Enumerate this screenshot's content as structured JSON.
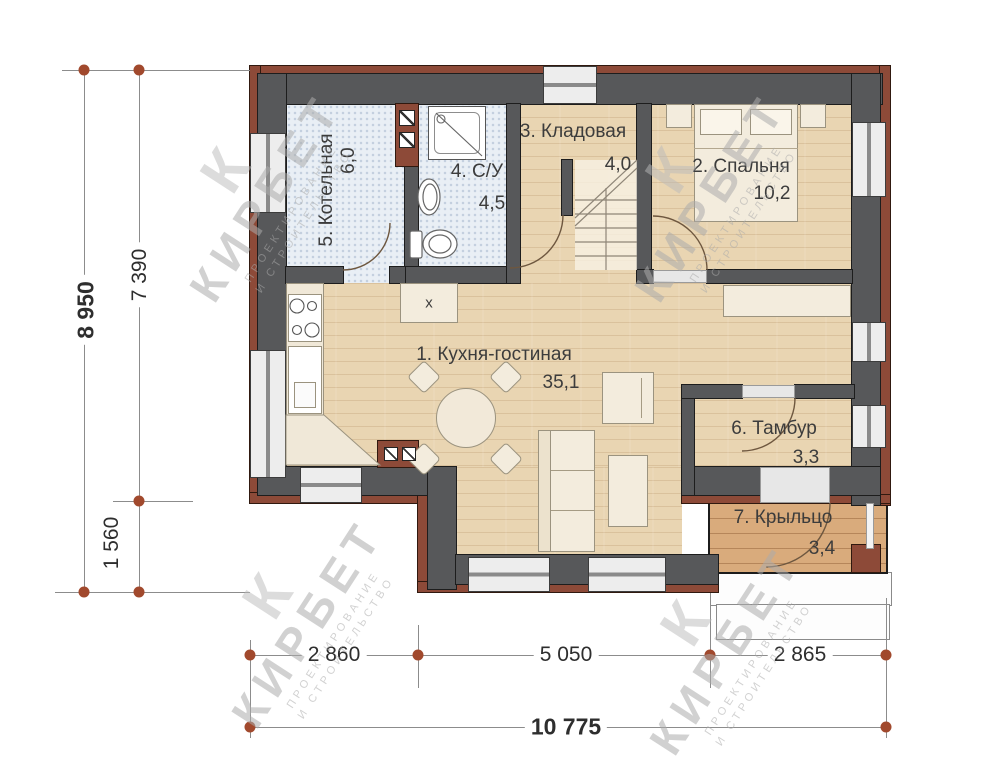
{
  "rooms": [
    {
      "label": "1. Кухня-гостиная",
      "area": "35,1"
    },
    {
      "label": "2. Спальня",
      "area": "10,2"
    },
    {
      "label": "3. Кладовая",
      "area": "4,0"
    },
    {
      "label": "4. С/У",
      "area": "4,5"
    },
    {
      "label": "5. Котельная",
      "area": "6,0"
    },
    {
      "label": "6. Тамбур",
      "area": "3,3"
    },
    {
      "label": "7. Крыльцо",
      "area": "3,4"
    }
  ],
  "labels": {
    "island": "х"
  },
  "dimensions": {
    "left_total": "8 950",
    "left_upper": "7 390",
    "left_lower": "1 560",
    "bottom_seg1": "2 860",
    "bottom_seg2": "5 050",
    "bottom_seg3": "2 865",
    "bottom_total": "10 775"
  },
  "watermark": {
    "mark": "К",
    "name": "КИРБЕТ",
    "subtitle1": "ПРОЕКТИРОВАНИЕ",
    "subtitle2": "И СТРОИТЕЛЬСТВО"
  },
  "colors": {
    "wall": "#57585a",
    "brick": "#8d4a38",
    "wood_floor": "#e9d5b2",
    "tile_floor": "#e9eff5",
    "porch_floor": "#d9ab7c",
    "dim_dot": "#a1492d"
  }
}
